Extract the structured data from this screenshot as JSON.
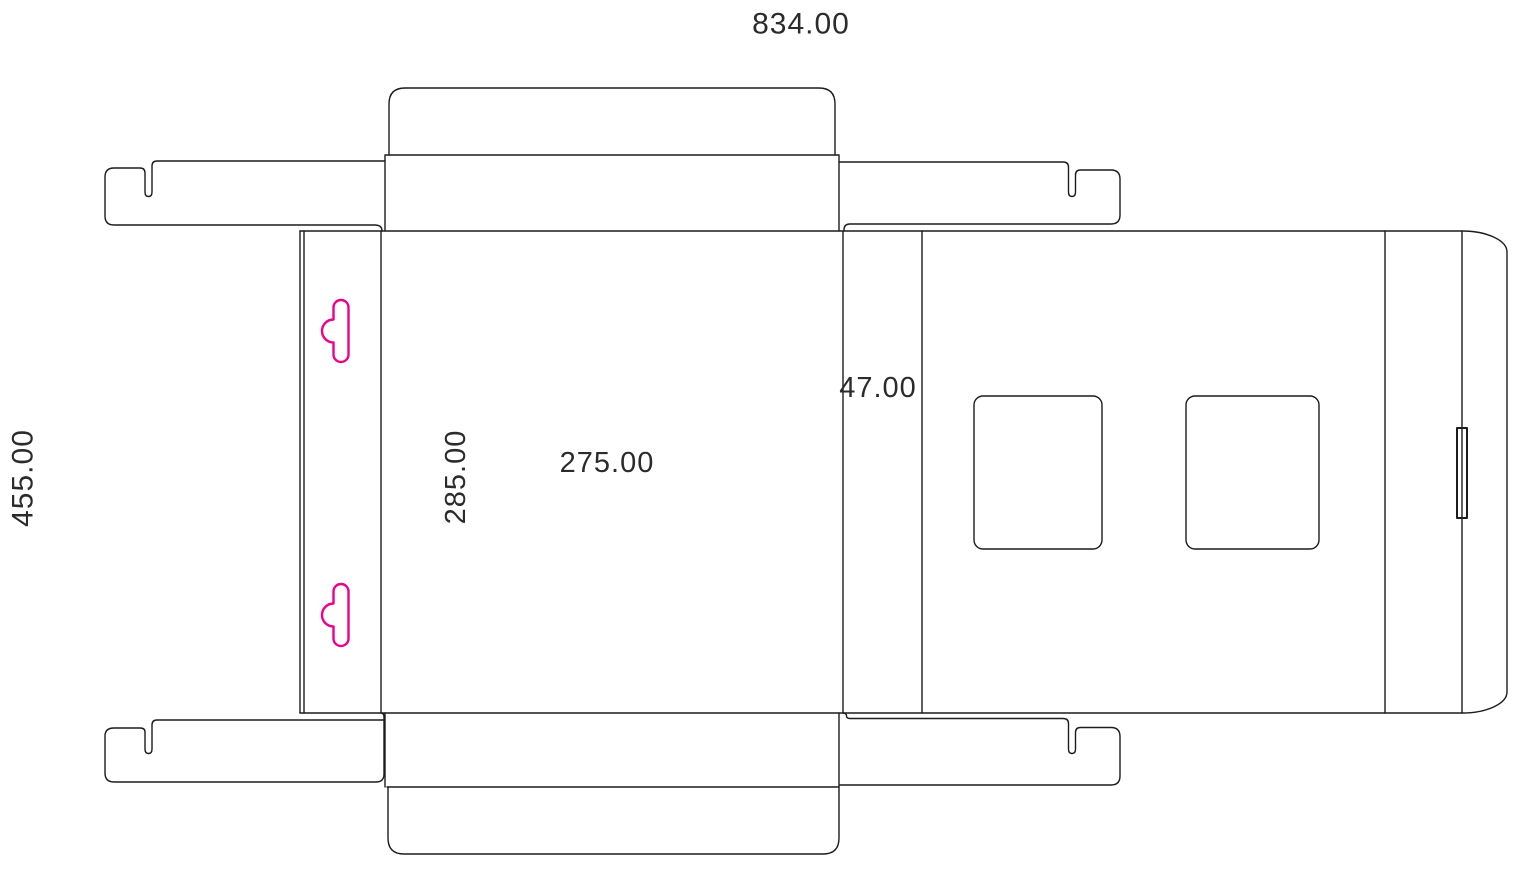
{
  "dieline": {
    "line_color": "#1c1c1c",
    "hang_hole_color": "#EC008C",
    "dimension_text_color": "#2b2b2b",
    "labels": {
      "total_width": "834.00",
      "total_height": "455.00",
      "panel_height": "285.00",
      "panel_width": "275.00",
      "side_panel_width": "47.00"
    }
  }
}
